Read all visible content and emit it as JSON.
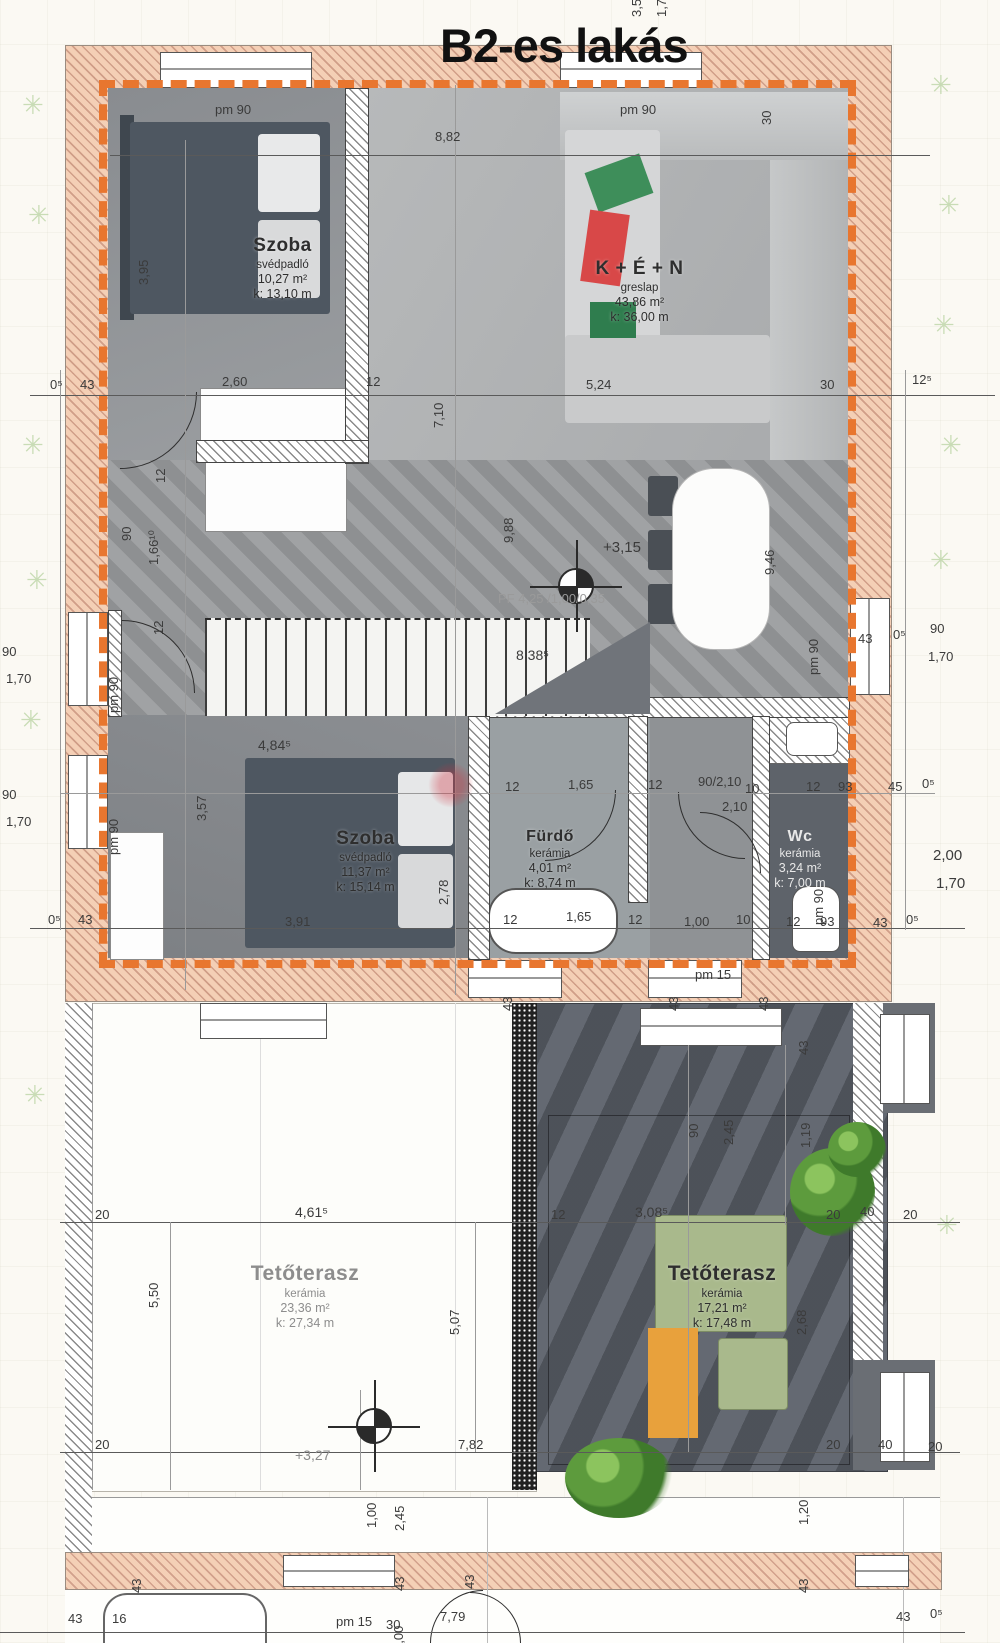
{
  "title": "B2-es lakás",
  "icons": {
    "tree": "✳"
  },
  "rooms": [
    {
      "name": "Szoba",
      "floor": "svédpadló",
      "area": "10,27 m²",
      "perimeter": "k:  13,10 m"
    },
    {
      "name": "K + É + N",
      "floor": "greslap",
      "area": "43,86 m²",
      "perimeter": "k:  36,00 m"
    },
    {
      "name": "Szoba",
      "floor": "svédpadló",
      "area": "11,37 m²",
      "perimeter": "k:  15,14 m"
    },
    {
      "name": "Fürdő",
      "floor": "kerámia",
      "area": "4,01 m²",
      "perimeter": "k:  8,74 m"
    },
    {
      "name": "Wc",
      "floor": "kerámia",
      "area": "3,24 m²",
      "perimeter": "k:  7,00 m"
    },
    {
      "name": "Tetőterasz",
      "floor": "kerámia",
      "area": "23,36 m²",
      "perimeter": "k:  27,34 m"
    },
    {
      "name": "Tetőterasz",
      "floor": "kerámia",
      "area": "17,21 m²",
      "perimeter": "k:  17,48 m"
    }
  ],
  "annotations": {
    "level_upper": "+3,15",
    "level_lower": "+3,27",
    "lintel_note": "PF 4,25 /1,00/0,35"
  },
  "dim_labels": [
    {
      "t": "3,5",
      "x": 643,
      "y": 4,
      "r": true
    },
    {
      "t": "1,7",
      "x": 668,
      "y": 4,
      "r": true
    },
    {
      "t": "pm 90",
      "x": 215,
      "y": 103
    },
    {
      "t": "pm 90",
      "x": 620,
      "y": 103
    },
    {
      "t": "8,82",
      "x": 435,
      "y": 130
    },
    {
      "t": "30",
      "x": 773,
      "y": 112,
      "r": true
    },
    {
      "t": "3,95",
      "x": 150,
      "y": 272,
      "r": true
    },
    {
      "t": "0⁵",
      "x": 50,
      "y": 378
    },
    {
      "t": "43",
      "x": 80,
      "y": 378
    },
    {
      "t": "2,60",
      "x": 222,
      "y": 375
    },
    {
      "t": "12",
      "x": 366,
      "y": 375
    },
    {
      "t": "7,10",
      "x": 445,
      "y": 415,
      "r": true
    },
    {
      "t": "5,24",
      "x": 586,
      "y": 378
    },
    {
      "t": "30",
      "x": 820,
      "y": 378
    },
    {
      "t": "12⁵",
      "x": 912,
      "y": 373
    },
    {
      "t": "12",
      "x": 167,
      "y": 470,
      "r": true
    },
    {
      "t": "90",
      "x": 133,
      "y": 528,
      "r": true
    },
    {
      "t": "1,66¹⁰",
      "x": 160,
      "y": 552,
      "r": true
    },
    {
      "t": "12",
      "x": 165,
      "y": 622,
      "r": true
    },
    {
      "t": "9,88",
      "x": 515,
      "y": 530,
      "r": true
    },
    {
      "t": "+3,15",
      "x": 603,
      "y": 540,
      "fs": 15
    },
    {
      "t": "9,46",
      "x": 776,
      "y": 562,
      "r": true
    },
    {
      "t": "PF 4,25 /1,00/0,35",
      "x": 498,
      "y": 592,
      "c": "#9a9a9a"
    },
    {
      "t": "8,38⁵",
      "x": 516,
      "y": 648,
      "fs": 14
    },
    {
      "t": "pm 90",
      "x": 820,
      "y": 662,
      "r": true
    },
    {
      "t": "43",
      "x": 858,
      "y": 632
    },
    {
      "t": "0⁵",
      "x": 893,
      "y": 628
    },
    {
      "t": "90",
      "x": 930,
      "y": 622
    },
    {
      "t": "1,70",
      "x": 928,
      "y": 650
    },
    {
      "t": "90",
      "x": 2,
      "y": 645
    },
    {
      "t": "1,70",
      "x": 6,
      "y": 672
    },
    {
      "t": "pm 90",
      "x": 120,
      "y": 700,
      "r": true
    },
    {
      "t": "90",
      "x": 2,
      "y": 788
    },
    {
      "t": "1,70",
      "x": 6,
      "y": 815
    },
    {
      "t": "pm 90",
      "x": 120,
      "y": 842,
      "r": true
    },
    {
      "t": "3,57",
      "x": 208,
      "y": 808,
      "r": true
    },
    {
      "t": "4,84⁵",
      "x": 258,
      "y": 738,
      "fs": 14
    },
    {
      "t": "2,78",
      "x": 450,
      "y": 892,
      "r": true
    },
    {
      "t": "12",
      "x": 505,
      "y": 780
    },
    {
      "t": "1,65",
      "x": 568,
      "y": 778
    },
    {
      "t": "12",
      "x": 648,
      "y": 778
    },
    {
      "t": "90/2,10",
      "x": 698,
      "y": 775
    },
    {
      "t": "2,10",
      "x": 722,
      "y": 800
    },
    {
      "t": "10",
      "x": 745,
      "y": 782
    },
    {
      "t": "12",
      "x": 806,
      "y": 780
    },
    {
      "t": "93",
      "x": 838,
      "y": 780
    },
    {
      "t": "45",
      "x": 888,
      "y": 780
    },
    {
      "t": "0⁵",
      "x": 922,
      "y": 777
    },
    {
      "t": "2,00",
      "x": 933,
      "y": 848,
      "fs": 15
    },
    {
      "t": "1,70",
      "x": 936,
      "y": 876,
      "fs": 15
    },
    {
      "t": "0⁵",
      "x": 48,
      "y": 913
    },
    {
      "t": "43",
      "x": 78,
      "y": 913
    },
    {
      "t": "3,91",
      "x": 285,
      "y": 915
    },
    {
      "t": "12",
      "x": 503,
      "y": 913
    },
    {
      "t": "1,65",
      "x": 566,
      "y": 910
    },
    {
      "t": "12",
      "x": 628,
      "y": 913
    },
    {
      "t": "1,00",
      "x": 684,
      "y": 915
    },
    {
      "t": "10",
      "x": 736,
      "y": 913
    },
    {
      "t": "12",
      "x": 786,
      "y": 915
    },
    {
      "t": "93",
      "x": 820,
      "y": 915
    },
    {
      "t": "43",
      "x": 873,
      "y": 916
    },
    {
      "t": "0⁵",
      "x": 906,
      "y": 913
    },
    {
      "t": "pm 90",
      "x": 825,
      "y": 912,
      "r": true
    },
    {
      "t": "pm 15",
      "x": 695,
      "y": 968
    },
    {
      "t": "43",
      "x": 514,
      "y": 998,
      "r": true
    },
    {
      "t": "43",
      "x": 680,
      "y": 998,
      "r": true
    },
    {
      "t": "43",
      "x": 770,
      "y": 998,
      "r": true
    },
    {
      "t": "43",
      "x": 810,
      "y": 1042,
      "r": true
    },
    {
      "t": "90",
      "x": 700,
      "y": 1125,
      "r": true
    },
    {
      "t": "2,45",
      "x": 735,
      "y": 1132,
      "r": true
    },
    {
      "t": "1,19",
      "x": 812,
      "y": 1135,
      "r": true
    },
    {
      "t": "20",
      "x": 95,
      "y": 1208
    },
    {
      "t": "4,61⁵",
      "x": 295,
      "y": 1205,
      "fs": 14
    },
    {
      "t": "12",
      "x": 551,
      "y": 1208
    },
    {
      "t": "3,08⁵",
      "x": 635,
      "y": 1205,
      "fs": 14
    },
    {
      "t": "20",
      "x": 826,
      "y": 1208
    },
    {
      "t": "40",
      "x": 860,
      "y": 1205
    },
    {
      "t": "20",
      "x": 903,
      "y": 1208
    },
    {
      "t": "5,50",
      "x": 160,
      "y": 1295,
      "r": true
    },
    {
      "t": "5,07",
      "x": 461,
      "y": 1322,
      "r": true
    },
    {
      "t": "2,68",
      "x": 808,
      "y": 1322,
      "r": true
    },
    {
      "t": "20",
      "x": 95,
      "y": 1438
    },
    {
      "t": "+3,27",
      "x": 295,
      "y": 1448,
      "c": "#8a8a8a",
      "fs": 14
    },
    {
      "t": "7,82",
      "x": 458,
      "y": 1438
    },
    {
      "t": "20",
      "x": 826,
      "y": 1438
    },
    {
      "t": "40",
      "x": 878,
      "y": 1438
    },
    {
      "t": "20",
      "x": 928,
      "y": 1440
    },
    {
      "t": "1,00",
      "x": 378,
      "y": 1515,
      "r": true
    },
    {
      "t": "2,45",
      "x": 406,
      "y": 1518,
      "r": true
    },
    {
      "t": "1,20",
      "x": 810,
      "y": 1512,
      "r": true
    },
    {
      "t": "43",
      "x": 143,
      "y": 1580,
      "r": true
    },
    {
      "t": "43",
      "x": 406,
      "y": 1578,
      "r": true
    },
    {
      "t": "43",
      "x": 476,
      "y": 1576,
      "r": true
    },
    {
      "t": "43",
      "x": 810,
      "y": 1580,
      "r": true
    },
    {
      "t": "43",
      "x": 68,
      "y": 1612
    },
    {
      "t": "16",
      "x": 112,
      "y": 1612
    },
    {
      "t": "pm 15",
      "x": 336,
      "y": 1615
    },
    {
      "t": "30",
      "x": 386,
      "y": 1618
    },
    {
      "t": "1,00",
      "x": 405,
      "y": 1638,
      "r": true
    },
    {
      "t": "7,79",
      "x": 440,
      "y": 1610
    },
    {
      "t": "43",
      "x": 896,
      "y": 1610
    },
    {
      "t": "0⁵",
      "x": 930,
      "y": 1607
    }
  ]
}
